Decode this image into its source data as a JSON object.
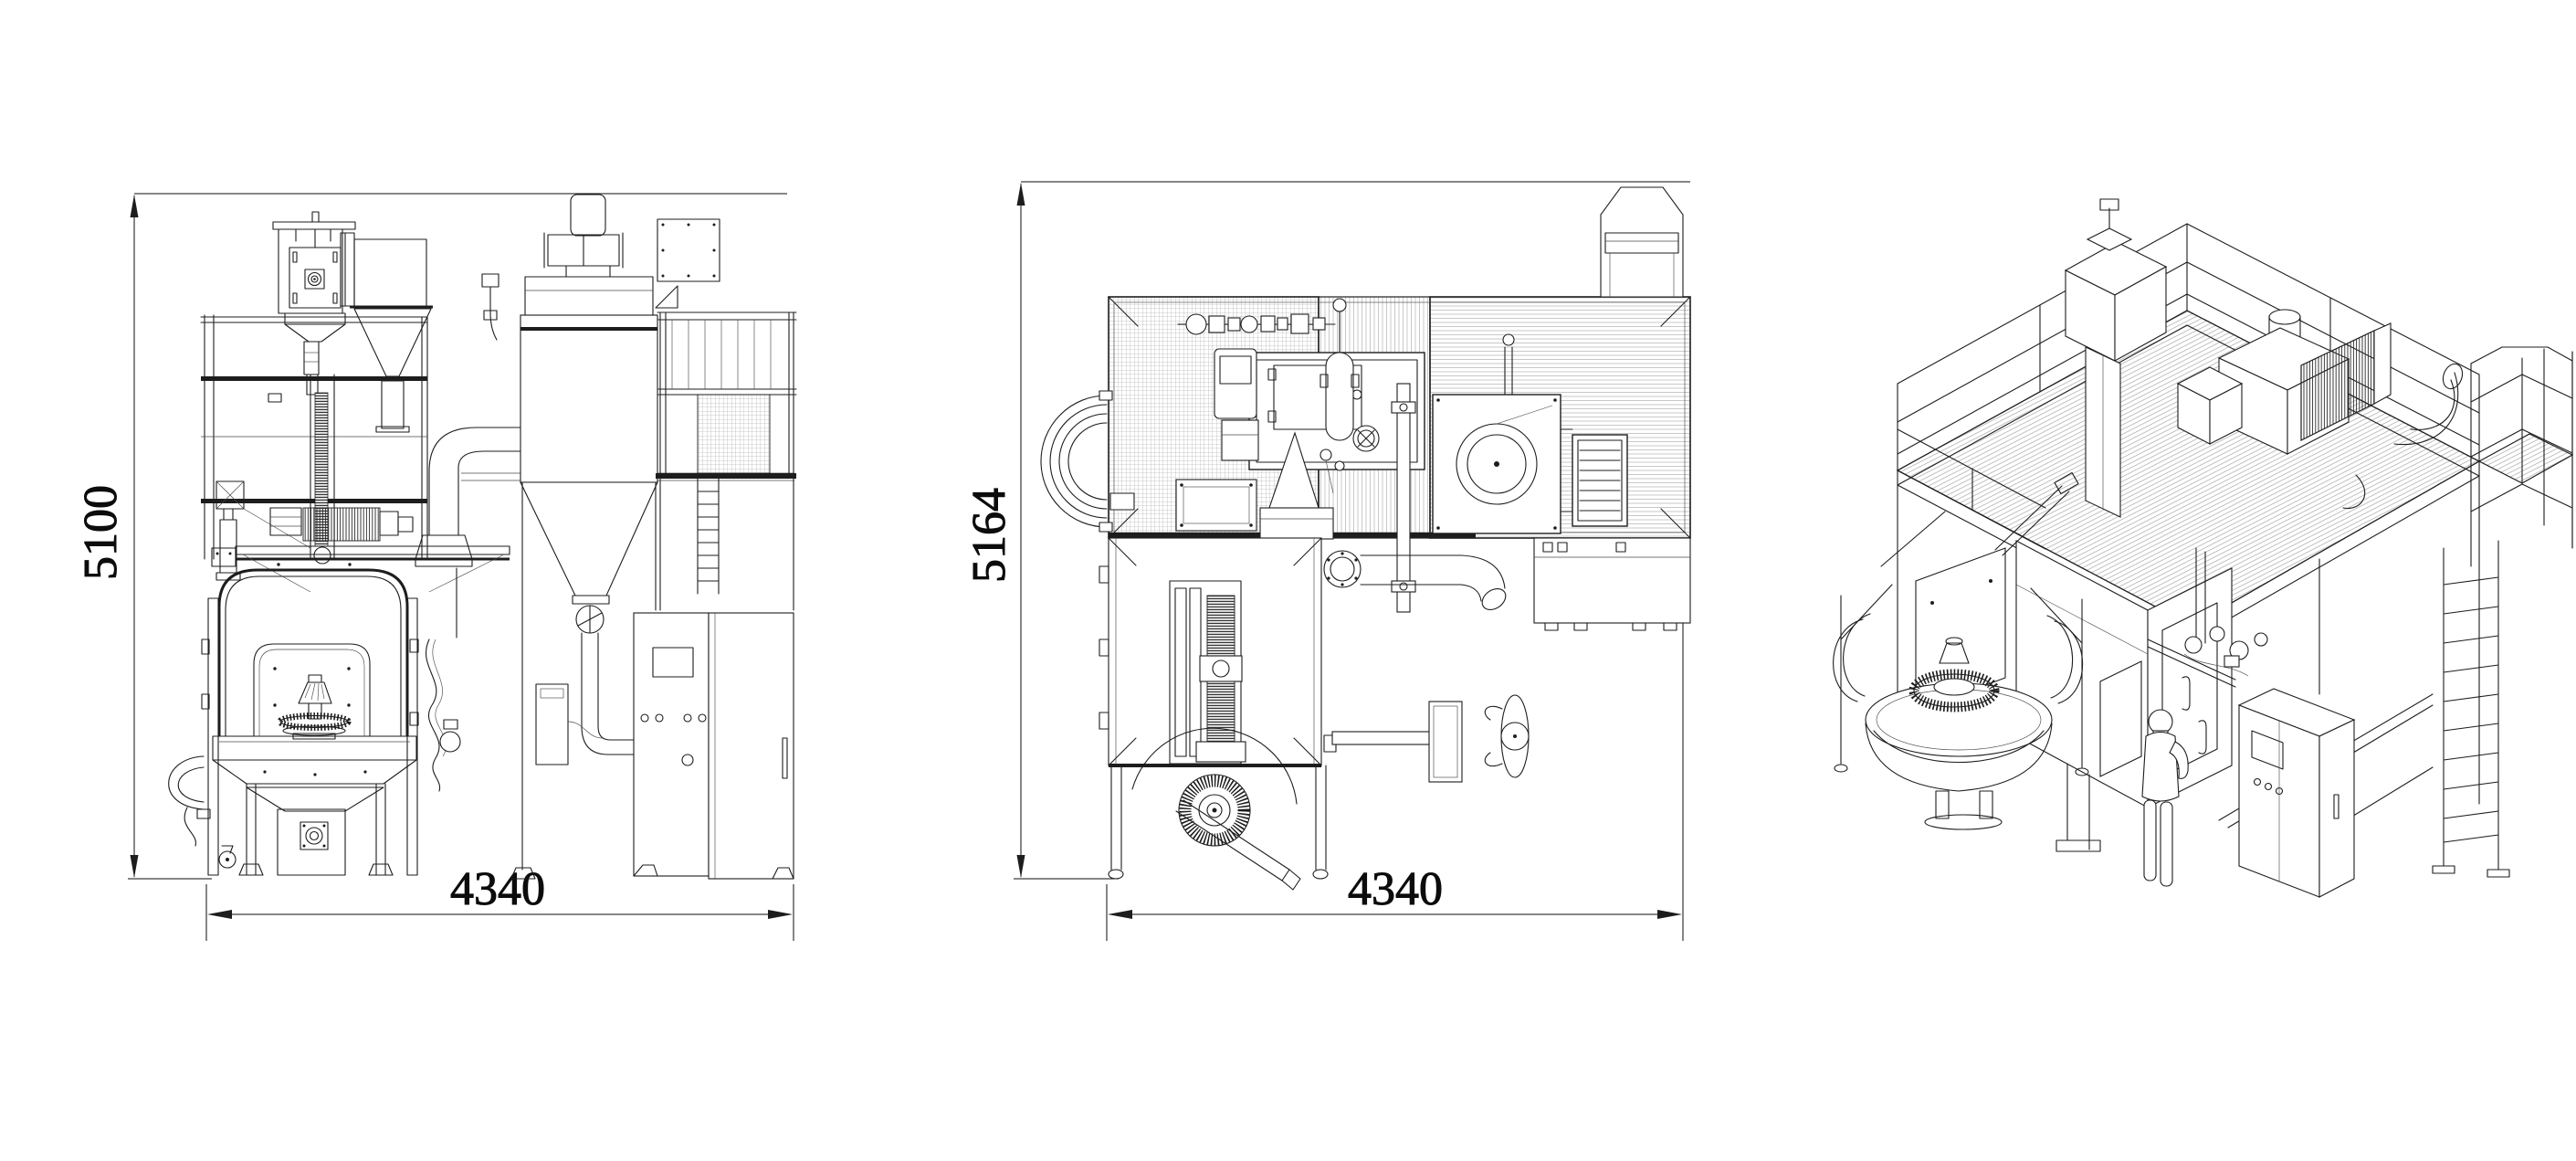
{
  "sheet": {
    "background": "#ffffff",
    "line_color": "#1d1d1d",
    "dim_color": "#0c0c0c"
  },
  "dimensions": {
    "front_height": "5100",
    "front_width": "4340",
    "plan_height": "5164",
    "plan_width": "4340"
  }
}
